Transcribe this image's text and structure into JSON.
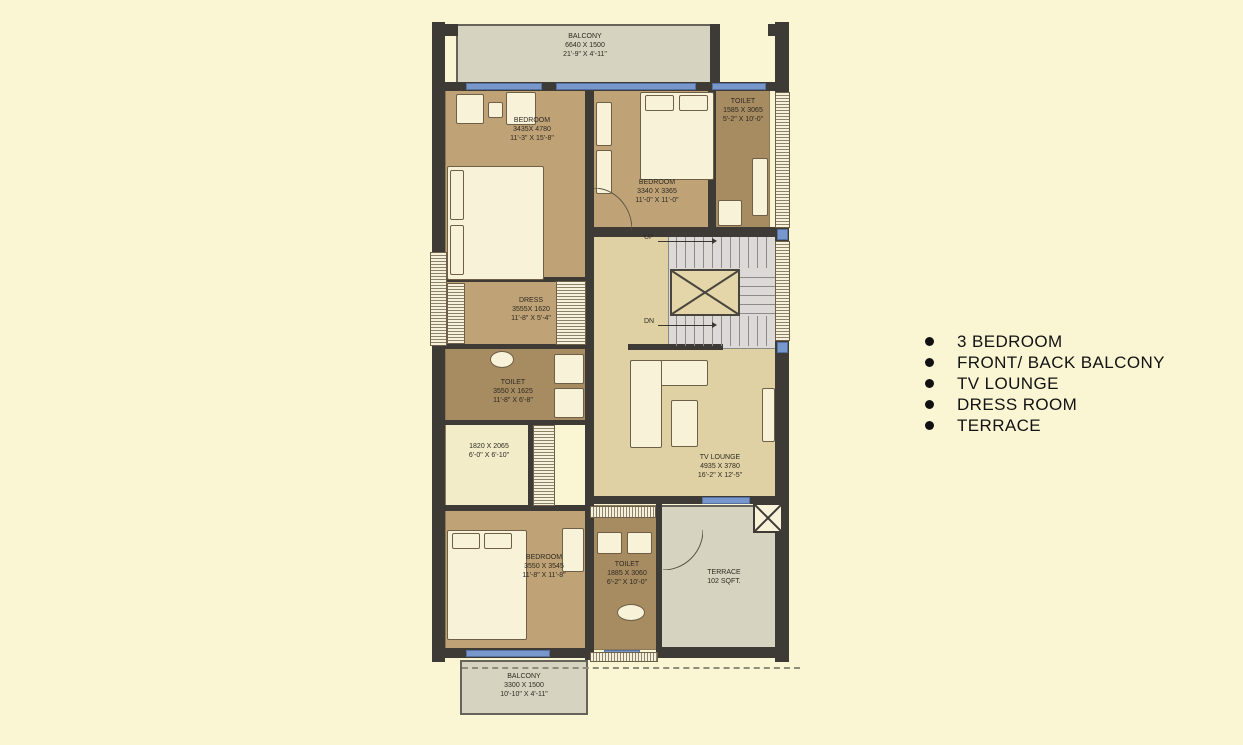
{
  "rooms": {
    "balcony_top": {
      "line1": "BALCONY",
      "line2": "6640 X 1500",
      "line3": "21'-9\" X 4'-11\""
    },
    "bedroom_top_left": {
      "line1": "BEDROOM",
      "line2": "3435X 4780",
      "line3": "11'-3\" X 15'-8\""
    },
    "bedroom_top_right": {
      "line1": "BEDROOM",
      "line2": "3340 X 3365",
      "line3": "11'-0\" X 11'-0\""
    },
    "toilet_top_right": {
      "line1": "TOILET",
      "line2": "1585 X 3065",
      "line3": "5'-2\" X 10'-0\""
    },
    "dress": {
      "line1": "DRESS",
      "line2": "3555X 1620",
      "line3": "11'-8\" X 5'-4\""
    },
    "toilet_mid": {
      "line1": "TOILET",
      "line2": "3550 X 1625",
      "line3": "11'-8\" X 6'-8\""
    },
    "store": {
      "line1": "1820 X 2065",
      "line2": "6'-0\" X 6'-10\""
    },
    "tv_lounge": {
      "line1": "TV LOUNGE",
      "line2": "4935 X 3780",
      "line3": "16'-2\" X 12'-5\""
    },
    "bedroom_bottom": {
      "line1": "BEDROOM",
      "line2": "3550 X 3545",
      "line3": "11'-8\" X 11'-8\""
    },
    "toilet_bottom": {
      "line1": "TOILET",
      "line2": "1885 X 3060",
      "line3": "6'-2\" X 10'-0\""
    },
    "terrace": {
      "line1": "TERRACE",
      "line2": "102 SQFT."
    },
    "balcony_bottom": {
      "line1": "BALCONY",
      "line2": "3300 X 1500",
      "line3": "10'-10\" X 4'-11\""
    }
  },
  "stairs": {
    "up": "UP",
    "dn": "DN"
  },
  "features": {
    "items": [
      "3 BEDROOM",
      "FRONT/ BACK BALCONY",
      "TV LOUNGE",
      "DRESS ROOM",
      "TERRACE"
    ]
  },
  "colors": {
    "background": "#FAF6D3",
    "bedroom": "#BFA377",
    "toilet": "#A78B61",
    "lounge": "#DFD1A3",
    "balcony": "#D6D3C1",
    "wall": "#3E3B37",
    "window": "#7897CC"
  }
}
